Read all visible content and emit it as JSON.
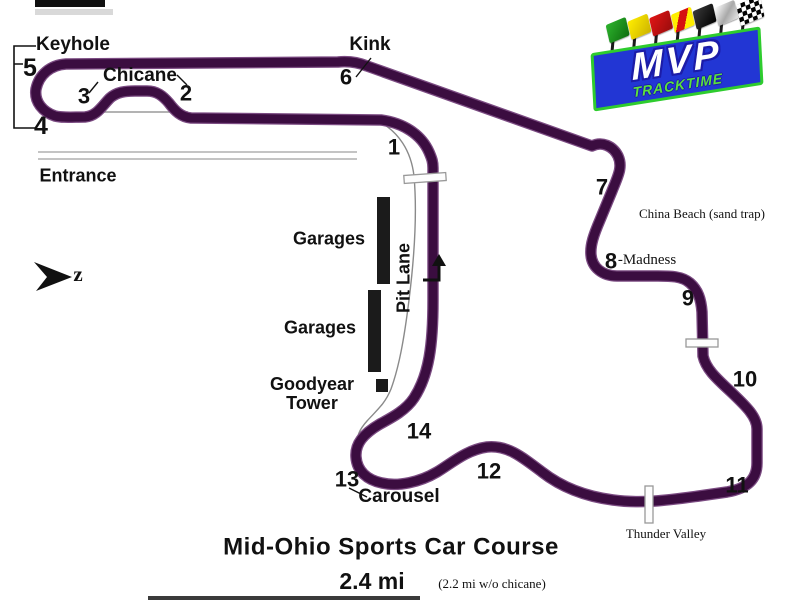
{
  "colors": {
    "track": "#3b0d40",
    "track_edge": "#7b4b82",
    "road": "#b0b0b0",
    "logo_blue": "#2236d4",
    "logo_green": "#2ecc2e"
  },
  "compass": {
    "label": "z"
  },
  "corners": {
    "t1": "1",
    "t2": "2",
    "t3": "3",
    "t4": "4",
    "t5": "5",
    "t6": "6",
    "t7": "7",
    "t8": "8",
    "t9": "9",
    "t10": "10",
    "t11": "11",
    "t12": "12",
    "t13": "13",
    "t14": "14"
  },
  "places": {
    "keyhole": "Keyhole",
    "chicane": "Chicane",
    "kink": "Kink",
    "entrance": "Entrance",
    "garages_upper": "Garages",
    "garages_lower": "Garages",
    "goodyear_line1": "Goodyear",
    "goodyear_line2": "Tower",
    "pit_lane": "Pit Lane",
    "carousel": "Carousel",
    "china_beach": "China Beach (sand trap)",
    "madness": "-Madness",
    "thunder_valley": "Thunder Valley"
  },
  "logo": {
    "mvp": "MVP",
    "tracktime": "TRACKTIME",
    "flags": [
      "green-flag",
      "yellow-flag",
      "red-flag",
      "debris-flag",
      "black-flag",
      "silver-flag",
      "checkered-flag"
    ]
  },
  "footer": {
    "title": "Mid-Ohio Sports Car Course",
    "distance": "2.4 mi",
    "note": "(2.2 mi w/o chicane)"
  }
}
